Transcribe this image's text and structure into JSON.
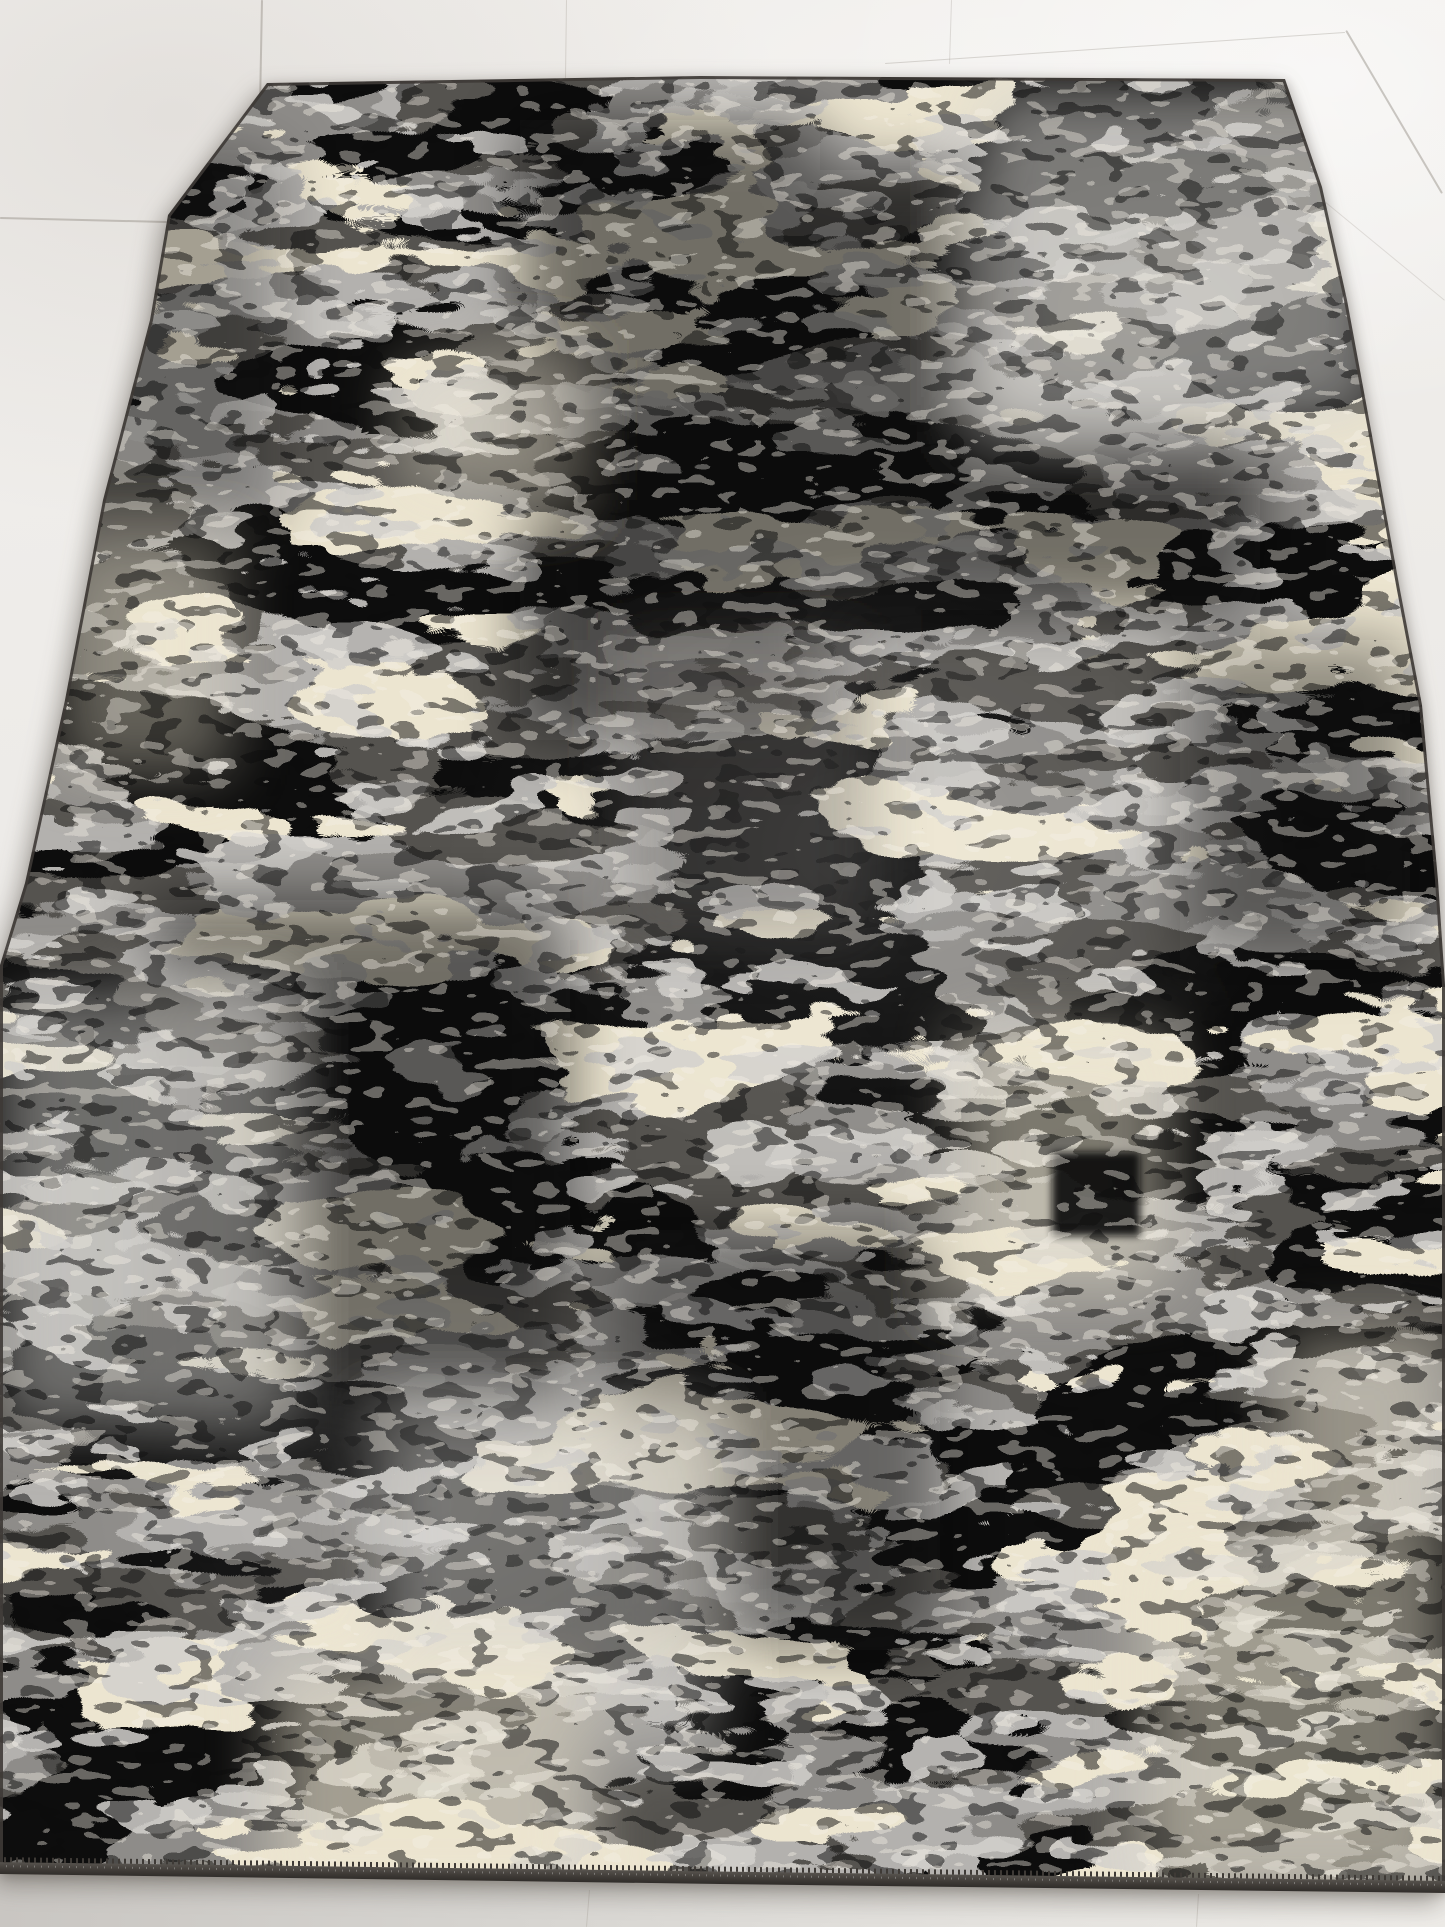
{
  "scene": {
    "type": "photograph",
    "description": "Abstract distressed rectangular area rug in black, charcoal, grey and cream tones lying flat on a white ceramic tile floor, photographed from a standing angle so the rug appears as a trapezoid widening toward the viewer",
    "objects": [
      "area-rug",
      "tile-floor"
    ],
    "rug_style": "modern abstract erased-patchwork pattern with mottled horizontal streaks and a dark serged binding edge with fine stitching teeth along the bottom"
  },
  "palette": {
    "floor_light": "#f2f0ed",
    "floor_mid": "#eceae7",
    "floor_dark": "#cfccc8",
    "grout": "#9a948c",
    "rug_base": "#b3b1ae",
    "rug_mid_gray": "#8e8c89",
    "rug_dark_gray": "#555350",
    "rug_black": "#0e0d0c",
    "rug_cream": "#ece5d0",
    "rug_light": "#d3d1cd",
    "rug_highlight": "#f5f1e6",
    "rug_edge": "#3e3a36"
  },
  "rug": {
    "polygon_points": [
      [
        267,
        83
      ],
      [
        700,
        76
      ],
      [
        1285,
        79
      ],
      [
        1322,
        187
      ],
      [
        1347,
        300
      ],
      [
        1371,
        430
      ],
      [
        1400,
        590
      ],
      [
        1422,
        705
      ],
      [
        1438,
        880
      ],
      [
        1445,
        985
      ],
      [
        1445,
        1893
      ],
      [
        720,
        1884
      ],
      [
        0,
        1874
      ],
      [
        0,
        965
      ],
      [
        25,
        883
      ],
      [
        65,
        700
      ],
      [
        103,
        500
      ],
      [
        150,
        320
      ],
      [
        168,
        215
      ]
    ],
    "binding_angle_deg": 0.75
  },
  "floor": {
    "grout_opacity": 0.45,
    "grout_lines": [
      {
        "x1": 263,
        "y1": 0,
        "x2": 259,
        "y2": 213,
        "w": 1.6,
        "o": 0.5
      },
      {
        "x1": 0,
        "y1": 217,
        "x2": 167,
        "y2": 221,
        "w": 1.6,
        "o": 0.5
      },
      {
        "x1": 567,
        "y1": 0,
        "x2": 566,
        "y2": 78,
        "w": 1.2,
        "o": 0.3
      },
      {
        "x1": 952,
        "y1": 0,
        "x2": 950,
        "y2": 64,
        "w": 1.2,
        "o": 0.28
      },
      {
        "x1": 885,
        "y1": 63,
        "x2": 1345,
        "y2": 32,
        "w": 1.3,
        "o": 0.35
      },
      {
        "x1": 1347,
        "y1": 30,
        "x2": 1443,
        "y2": 193,
        "w": 1.8,
        "o": 0.5
      },
      {
        "x1": 1326,
        "y1": 202,
        "x2": 1445,
        "y2": 300,
        "w": 1.3,
        "o": 0.25
      },
      {
        "x1": 590,
        "y1": 1890,
        "x2": 587,
        "y2": 1927,
        "w": 1.3,
        "o": 0.3
      },
      {
        "x1": 1199,
        "y1": 1894,
        "x2": 1197,
        "y2": 1927,
        "w": 1.3,
        "o": 0.3
      }
    ]
  }
}
